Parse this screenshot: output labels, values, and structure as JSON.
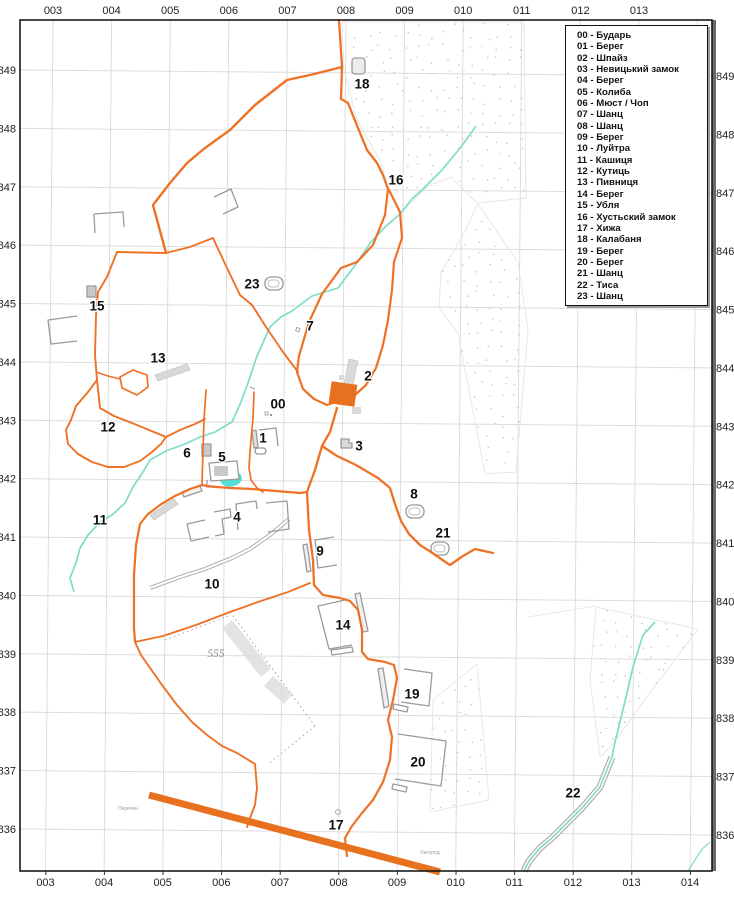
{
  "map_title": "Archaeological sites map sheet",
  "legend": {
    "items": [
      {
        "num": "00",
        "name": "Бударь"
      },
      {
        "num": "01",
        "name": "Берег"
      },
      {
        "num": "02",
        "name": "Шпайз"
      },
      {
        "num": "03",
        "name": "Невицький замок"
      },
      {
        "num": "04",
        "name": "Берег"
      },
      {
        "num": "05",
        "name": "Колиба"
      },
      {
        "num": "06",
        "name": "Мюст / Чоп"
      },
      {
        "num": "07",
        "name": "Шанц"
      },
      {
        "num": "08",
        "name": "Шанц"
      },
      {
        "num": "09",
        "name": "Берег"
      },
      {
        "num": "10",
        "name": "Луйтра"
      },
      {
        "num": "11",
        "name": "Кашиця"
      },
      {
        "num": "12",
        "name": "Кутиць"
      },
      {
        "num": "13",
        "name": "Пивниця"
      },
      {
        "num": "14",
        "name": "Берег"
      },
      {
        "num": "15",
        "name": "Убля"
      },
      {
        "num": "16",
        "name": "Хустьский замок"
      },
      {
        "num": "17",
        "name": "Хижа"
      },
      {
        "num": "18",
        "name": "Калабаня"
      },
      {
        "num": "19",
        "name": "Берег"
      },
      {
        "num": "20",
        "name": "Берег"
      },
      {
        "num": "21",
        "name": "Шанц"
      },
      {
        "num": "22",
        "name": "Тиса"
      },
      {
        "num": "23",
        "name": "Шанц"
      }
    ]
  },
  "axes": {
    "top": [
      "003",
      "004",
      "005",
      "006",
      "007",
      "008",
      "009",
      "010",
      "011",
      "012",
      "013"
    ],
    "bottom": [
      "003",
      "004",
      "005",
      "006",
      "007",
      "008",
      "009",
      "010",
      "011",
      "012",
      "013",
      "014"
    ],
    "left": [
      "849",
      "848",
      "847",
      "846",
      "845",
      "844",
      "843",
      "842",
      "841",
      "840",
      "839",
      "838",
      "837",
      "836"
    ],
    "right": [
      "849",
      "848",
      "847",
      "846",
      "845",
      "844",
      "843",
      "842",
      "841",
      "840",
      "839",
      "838",
      "837",
      "836"
    ]
  },
  "map_labels": [
    {
      "text": "00",
      "x": 278,
      "y": 404
    },
    {
      "text": "1",
      "x": 263,
      "y": 438
    },
    {
      "text": "2",
      "x": 368,
      "y": 376
    },
    {
      "text": "3",
      "x": 359,
      "y": 446
    },
    {
      "text": "4",
      "x": 237,
      "y": 517
    },
    {
      "text": "5",
      "x": 222,
      "y": 457
    },
    {
      "text": "6",
      "x": 187,
      "y": 453
    },
    {
      "text": "7",
      "x": 310,
      "y": 326
    },
    {
      "text": "8",
      "x": 414,
      "y": 494
    },
    {
      "text": "9",
      "x": 320,
      "y": 551
    },
    {
      "text": "10",
      "x": 212,
      "y": 584
    },
    {
      "text": "11",
      "x": 100,
      "y": 520
    },
    {
      "text": "12",
      "x": 108,
      "y": 427
    },
    {
      "text": "13",
      "x": 158,
      "y": 358
    },
    {
      "text": "14",
      "x": 343,
      "y": 625
    },
    {
      "text": "15",
      "x": 97,
      "y": 306
    },
    {
      "text": "16",
      "x": 396,
      "y": 180
    },
    {
      "text": "17",
      "x": 336,
      "y": 825
    },
    {
      "text": "18",
      "x": 362,
      "y": 84
    },
    {
      "text": "19",
      "x": 412,
      "y": 694
    },
    {
      "text": "20",
      "x": 418,
      "y": 762
    },
    {
      "text": "21",
      "x": 443,
      "y": 533
    },
    {
      "text": "22",
      "x": 573,
      "y": 793
    },
    {
      "text": "23",
      "x": 252,
      "y": 284
    }
  ],
  "annotations": {
    "area_label": {
      "text": "555",
      "x": 216,
      "y": 657
    },
    "small_texts": [
      {
        "text": "Перечин",
        "x": 128,
        "y": 810
      },
      {
        "text": "Ужгород",
        "x": 430,
        "y": 854
      }
    ]
  },
  "colors": {
    "road": "#ee7226",
    "highway": "#e8711f",
    "stream": "#7fdcc8",
    "pond": "#52e0d6",
    "grid": "#dcdcdc",
    "frame": "#1a1a1a",
    "building": "#9a9a9a",
    "building_fill": "#d9d9d9",
    "stipple": "#c6c6c6",
    "faint": "#e2e2e2",
    "label": "#0d0d0d",
    "axis_text": "#222222"
  }
}
